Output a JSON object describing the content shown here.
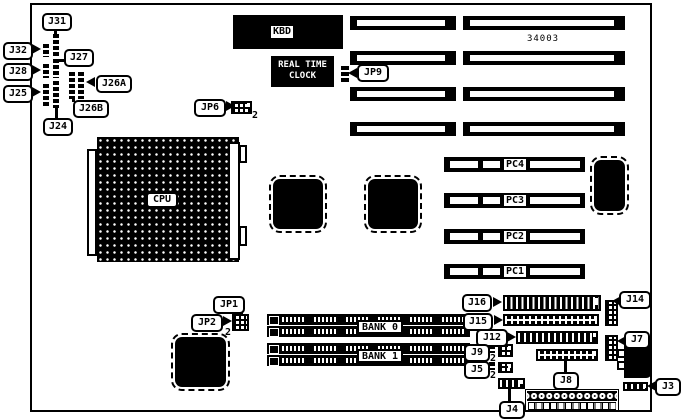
{
  "part_number": "34003",
  "chips": {
    "kbd": "KBD",
    "rtc_line1": "REAL TIME",
    "rtc_line2": "CLOCK",
    "cpu": "CPU"
  },
  "slots": {
    "pc1": "PC1",
    "pc2": "PC2",
    "pc3": "PC3",
    "pc4": "PC4"
  },
  "memory": {
    "bank0": "BANK 0",
    "bank1": "BANK 1"
  },
  "jumpers": {
    "j31": "J31",
    "j32": "J32",
    "j27": "J27",
    "j28": "J28",
    "j26a": "J26A",
    "j25": "J25",
    "j26b": "J26B",
    "j24": "J24",
    "jp9": "JP9",
    "jp6": "JP6",
    "jp1": "JP1",
    "jp2": "JP2"
  },
  "connectors": {
    "j16": "J16",
    "j15": "J15",
    "j14": "J14",
    "j12": "J12",
    "j9": "J9",
    "j7": "J7",
    "j5": "J5",
    "j8": "J8",
    "j4": "J4",
    "j3": "J3"
  },
  "pins": {
    "two": "2"
  }
}
